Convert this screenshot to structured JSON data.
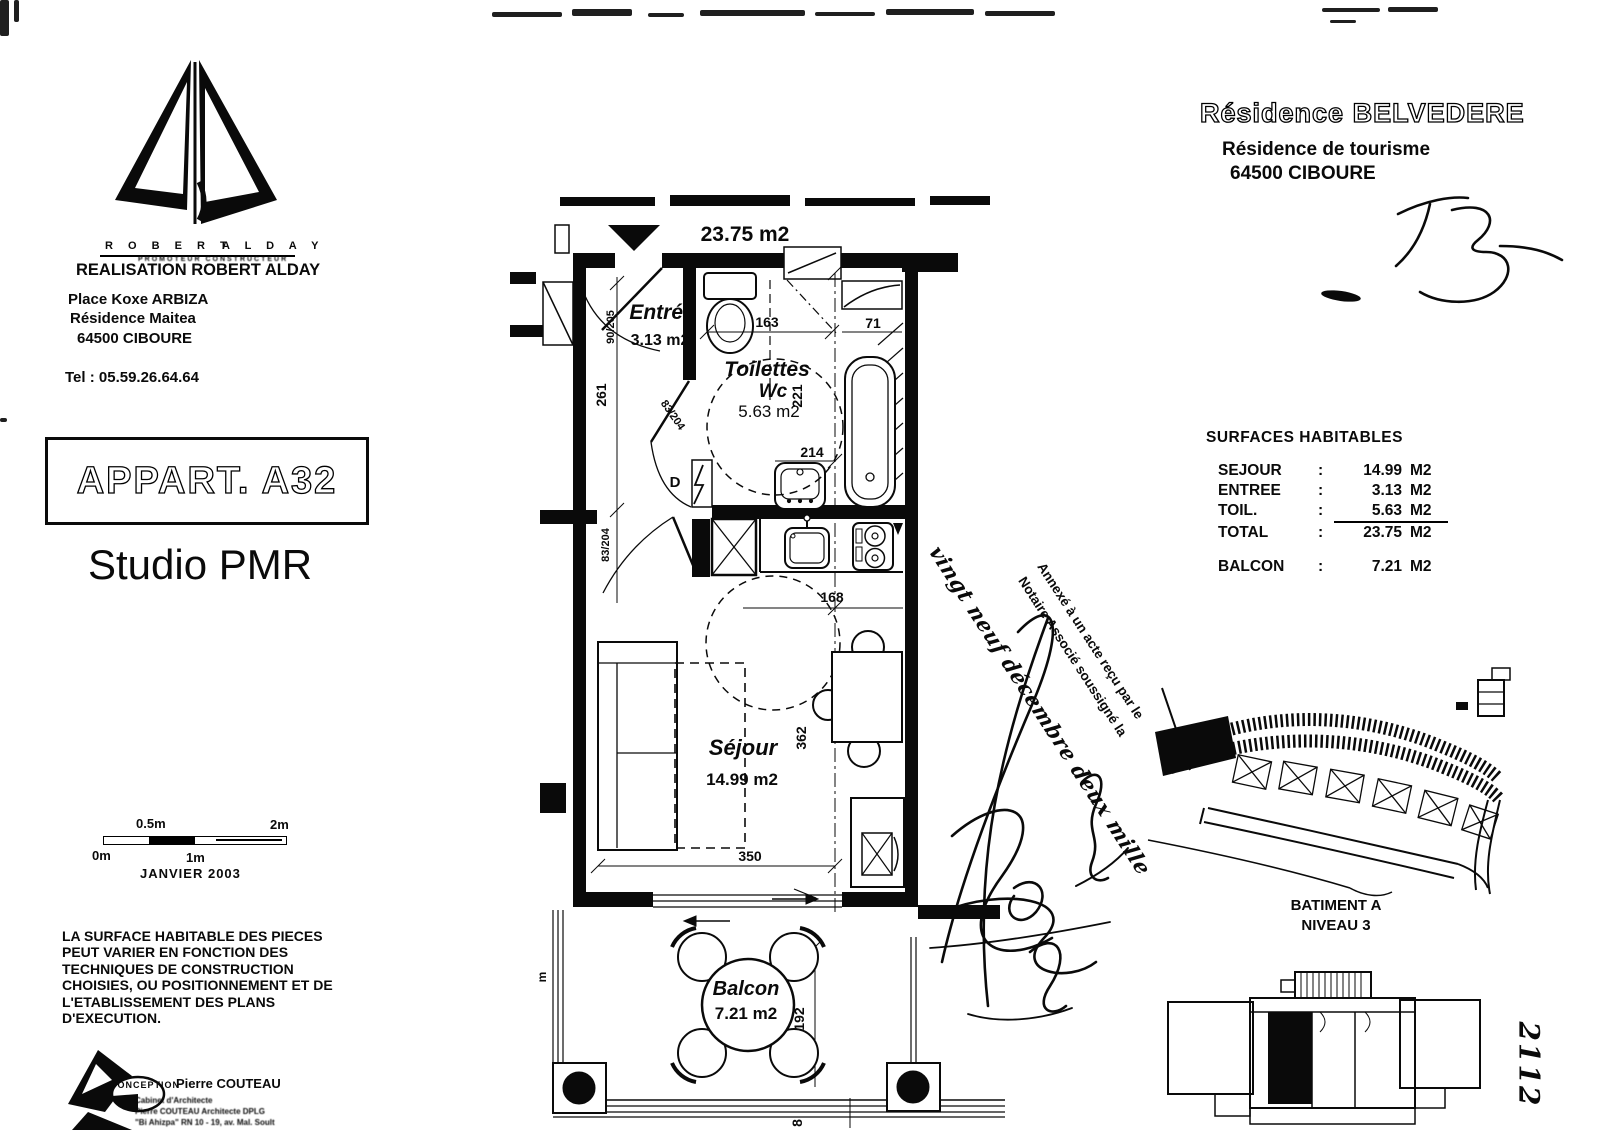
{
  "page": {
    "developer": {
      "logo_left": "R O B E R T",
      "logo_right": "A L D A Y",
      "logo_sub": "PROMOTEUR  CONSTRUCTEUR",
      "realisation": "REALISATION ROBERT ALDAY",
      "address1": "Place Koxe ARBIZA",
      "address2": "Résidence Maitea",
      "address3": "64500 CIBOURE",
      "phone": "Tel : 05.59.26.64.64"
    },
    "apartment": {
      "code": "APPART. A32",
      "type": "Studio PMR"
    },
    "scale": {
      "t0": "0m",
      "t05": "0.5m",
      "t1": "1m",
      "t2": "2m"
    },
    "date": "JANVIER  2003",
    "disclaimer": [
      "LA SURFACE HABITABLE DES PIECES",
      "PEUT VARIER EN FONCTION DES",
      "TECHNIQUES DE CONSTRUCTION",
      "CHOISIES, OU POSITIONNEMENT ET DE",
      "L'ETABLISSEMENT DES PLANS",
      "D'EXECUTION."
    ],
    "architect": {
      "label": "CONCEPTION",
      "name": "Pierre COUTEAU",
      "line1": "Cabinet d'Architecte",
      "line2": "Pierre COUTEAU Architecte DPLG",
      "line3": "\"Bi Ahizpa\" RN 10 - 19, av. Mal. Soult"
    },
    "residence": {
      "name": "Résidence  BELVEDERE",
      "subtitle": "Résidence de tourisme",
      "city": "64500 CIBOURE"
    },
    "surfaces": {
      "title": "SURFACES HABITABLES",
      "rows": [
        {
          "label": "SEJOUR",
          "colon": ":",
          "value": "14.99",
          "unit": "M2"
        },
        {
          "label": "ENTREE",
          "colon": ":",
          "value": "3.13",
          "unit": "M2"
        },
        {
          "label": "TOIL.",
          "colon": ":",
          "value": "5.63",
          "unit": "M2"
        },
        {
          "label": "TOTAL",
          "colon": ":",
          "value": "23.75",
          "unit": "M2"
        }
      ],
      "balcon": {
        "label": "BALCON",
        "colon": ":",
        "value": "7.21",
        "unit": "M2"
      }
    },
    "plan": {
      "total_area": "23.75 m2",
      "entree": {
        "name": "Entrée",
        "area": "3.13 m2"
      },
      "toilettes": {
        "name": "Toilettes",
        "name2": "Wc",
        "area": "5.63 m2"
      },
      "sejour": {
        "name": "Séjour",
        "area": "14.99 m2"
      },
      "balcon": {
        "name": "Balcon",
        "area": "7.21 m2"
      },
      "dims": {
        "entry_door": "90/205",
        "entree_length": "261",
        "sejour_door": "83/204",
        "toilettes_door": "83/204",
        "toilettes_width": "163",
        "bath_width": "71",
        "toilettes_depth": "221",
        "basin_width": "214",
        "kitchen_width": "168",
        "sejour_depth": "362",
        "sejour_width": "350",
        "balcon_depth": "192",
        "balcon_width": "8",
        "door_tag": "D",
        "rail_tag": "m"
      }
    },
    "notary": {
      "line1": "Annexé à un acte reçu par le",
      "line2": "Notaire Associé soussigné la",
      "handwritten": "vingt neuf décembre deux mille"
    },
    "keyplan": {
      "batiment": "BATIMENT A",
      "niveau": "NIVEAU 3"
    },
    "folio": "2112"
  }
}
